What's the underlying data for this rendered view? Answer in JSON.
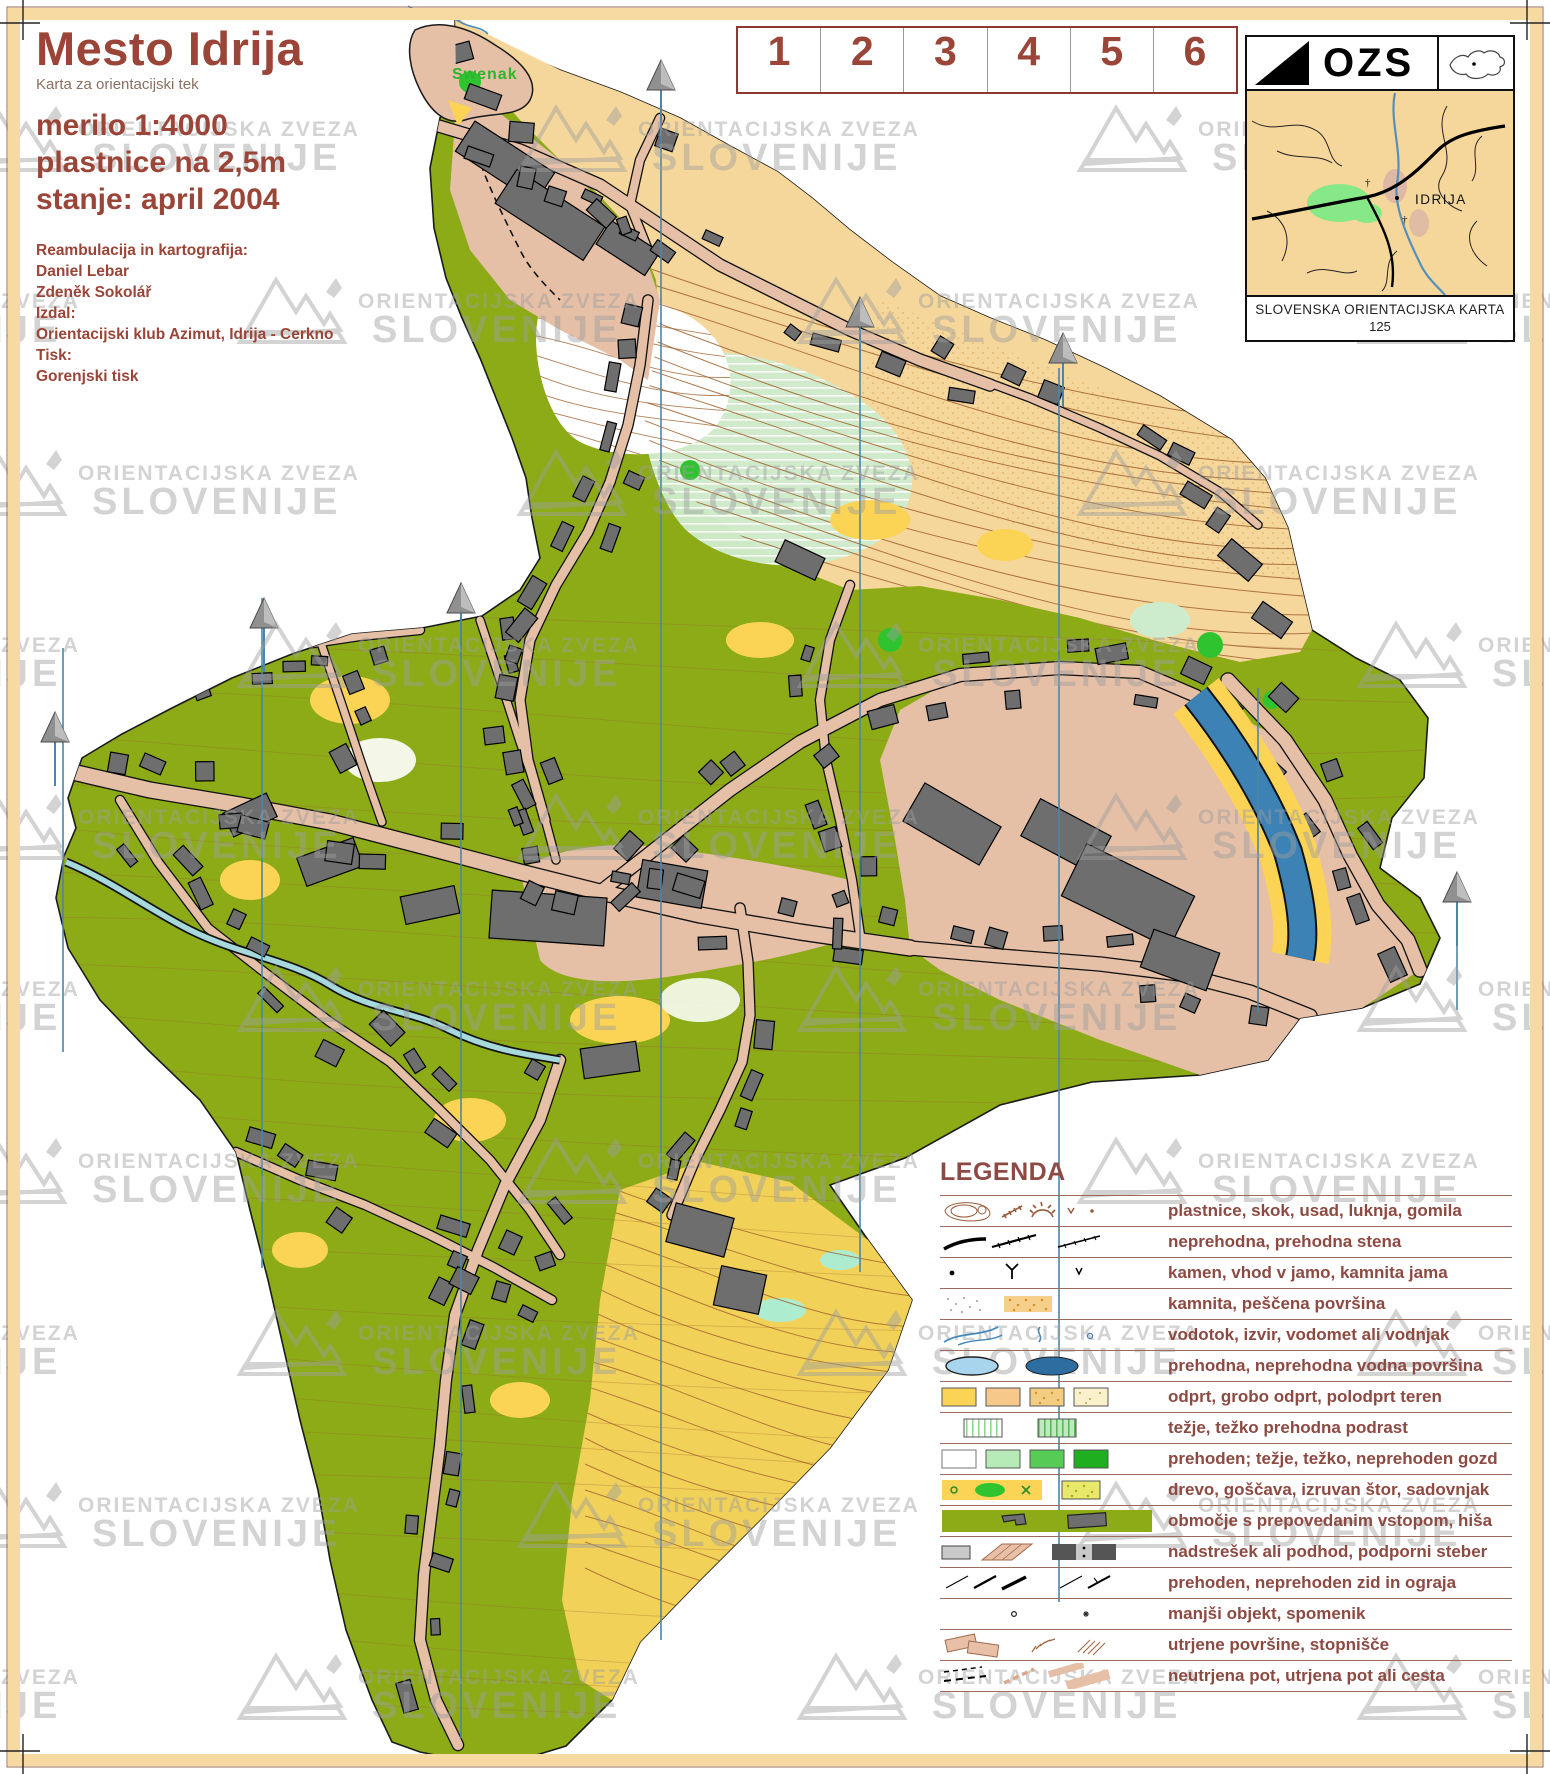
{
  "title": {
    "main": "Mesto Idrija",
    "subtitle": "Karta za orientacijski tek",
    "scale": "merilo 1:4000",
    "contours": "plastnice na 2,5m",
    "status": "stanje: april 2004"
  },
  "credits": {
    "lines": [
      "Reambulacija in kartografija:",
      "Daniel Lebar",
      "Zdeněk Sokolář",
      "Izdal:",
      "Orientacijski klub Azimut, Idrija - Cerkno",
      "Tisk:",
      "Gorenjski tisk"
    ]
  },
  "control_card": {
    "numbers": [
      "1",
      "2",
      "3",
      "4",
      "5",
      "6"
    ]
  },
  "ozs": {
    "abbr": "OZS",
    "caption": "SLOVENSKA ORIENTACIJSKA KARTA",
    "number": "125",
    "inset_label": "IDRIJA"
  },
  "map_labels": {
    "hill": "Swenak"
  },
  "watermark": {
    "line1": "ORIENTACIJSKA ZVEZA",
    "line2": "SLOVENIJE"
  },
  "legend": {
    "heading": "LEGENDA",
    "rows": [
      {
        "label": "plastnice, skok, usad, luknja, gomila"
      },
      {
        "label": "neprehodna, prehodna stena"
      },
      {
        "label": "kamen, vhod v jamo, kamnita jama"
      },
      {
        "label": "kamnita, peščena površina"
      },
      {
        "label": "vodotok, izvir, vodomet ali vodnjak"
      },
      {
        "label": "prehodna, neprehodna vodna površina"
      },
      {
        "label": "odprt, grobo odprt, polodprt teren"
      },
      {
        "label": "težje, težko prehodna podrast"
      },
      {
        "label": "prehoden; težje, težko, neprehoden gozd"
      },
      {
        "label": "drevo, goščava, izruvan štor, sadovnjak"
      },
      {
        "label": "območje s prepovedanim vstopom, hiša"
      },
      {
        "label": "nadstrešek ali podhod, podporni steber"
      },
      {
        "label": "prehoden, neprehoden zid in ograja"
      },
      {
        "label": "manjši objekt, spomenik"
      },
      {
        "label": "utrjene površine, stopnišče"
      },
      {
        "label": "neutrjena pot, utrjena pot ali cesta"
      }
    ]
  },
  "colors": {
    "accent_maroon": "#9a4538",
    "legend_text": "#8d4a42",
    "olive_forbidden": "#8cab17",
    "road_tan": "#e5bfa6",
    "sand": "#f6d79b",
    "open_yellow": "#fbd456",
    "building_gray": "#6e6e6e",
    "river_blue": "#3c82b4",
    "stream_blue": "#a6d8dc",
    "north_line_blue": "#4a86aa",
    "contour_brown": "#a0622e",
    "frame_peach": "#f7d9a2",
    "watermark_gray": "#c6c6c6"
  }
}
